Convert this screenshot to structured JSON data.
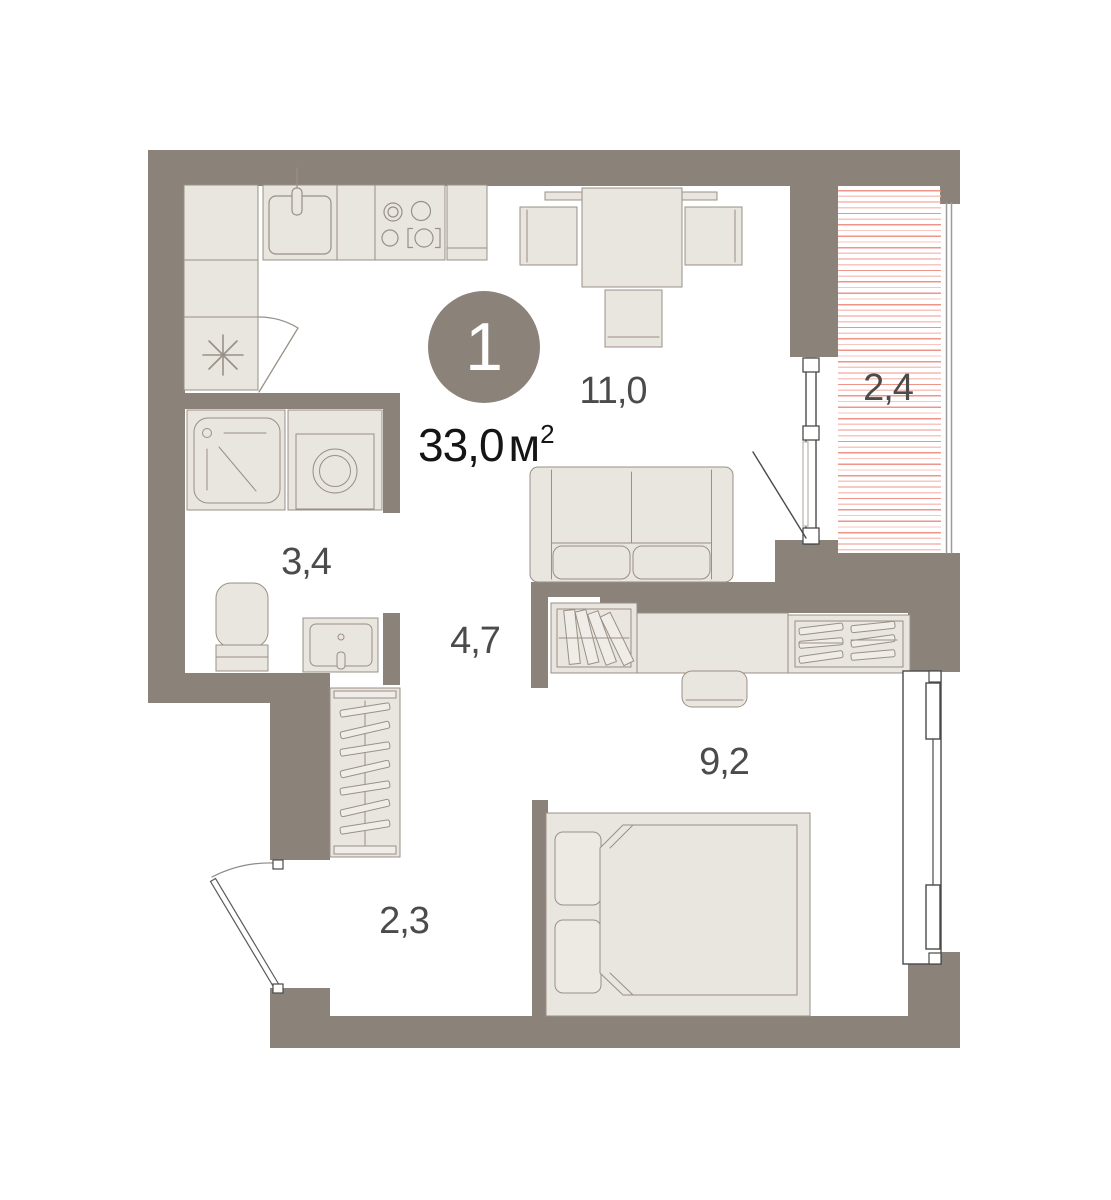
{
  "plan": {
    "unit_badge": {
      "number": "1"
    },
    "total_area": {
      "value": "33,0",
      "unit": "м",
      "power": "2"
    },
    "rooms": [
      {
        "id": "living-kitchen",
        "area": "11,0"
      },
      {
        "id": "balcony",
        "area": "2,4"
      },
      {
        "id": "bathroom",
        "area": "3,4"
      },
      {
        "id": "hallway",
        "area": "4,7"
      },
      {
        "id": "bedroom",
        "area": "9,2"
      },
      {
        "id": "entry-hall",
        "area": "2,3"
      }
    ],
    "colors": {
      "wall": "#8B8379",
      "fixture_fill": "#E9E5DF",
      "fixture_fill_light": "#F0EDE8",
      "fixture_stroke": "#9A9086",
      "frame_stroke": "#4A4A4A",
      "door_arc": "#8A8A8A",
      "balcony_hatch": "#EE9488",
      "balcony_hatch_light": "#F7C6BE",
      "label_text": "#4B4B4B",
      "total_text": "#151515",
      "badge_bg": "#8B8379"
    }
  }
}
